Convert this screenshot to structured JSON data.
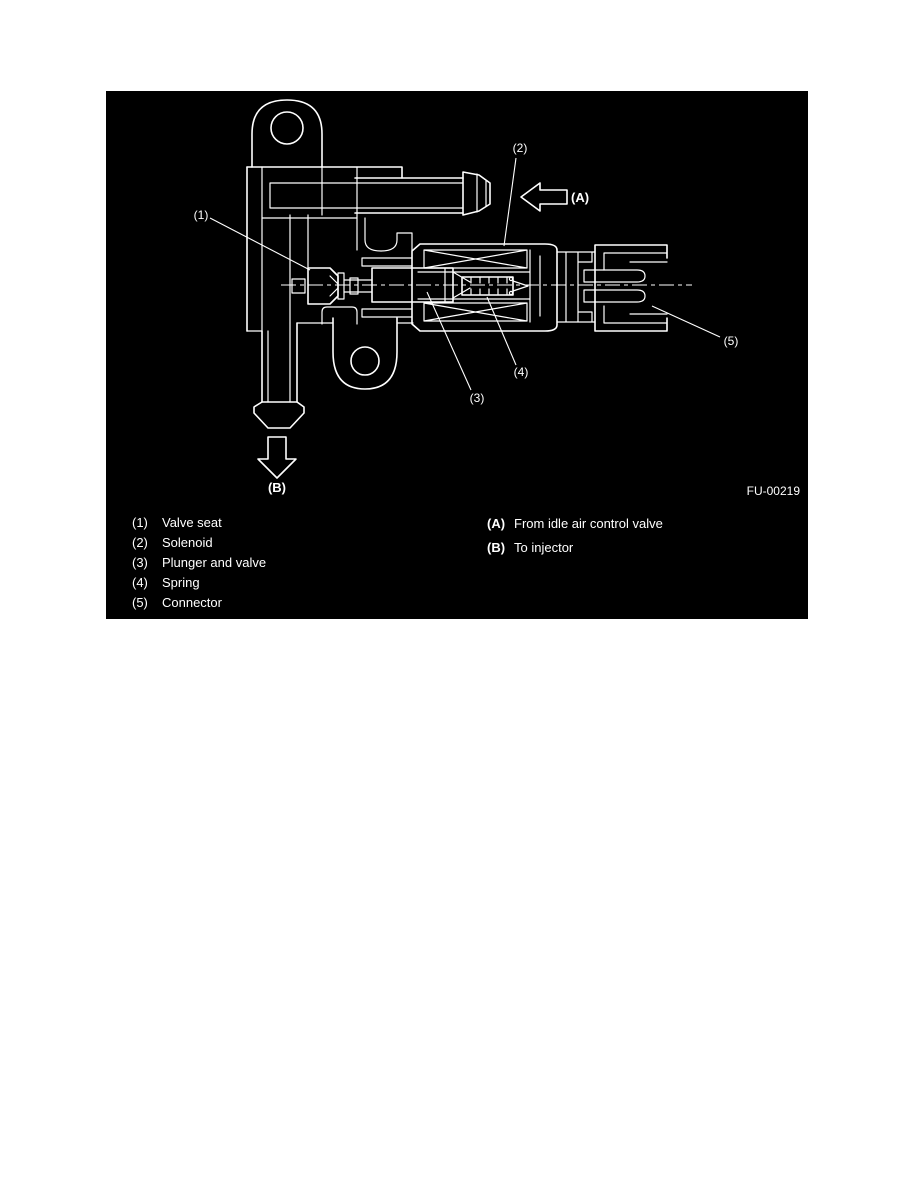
{
  "figure": {
    "code": "FU-00219",
    "callouts": {
      "1": "(1)",
      "2": "(2)",
      "3": "(3)",
      "4": "(4)",
      "5": "(5)",
      "A": "(A)",
      "B": "(B)"
    },
    "legend_left": [
      {
        "marker": "(1)",
        "label": "Valve seat"
      },
      {
        "marker": "(2)",
        "label": "Solenoid"
      },
      {
        "marker": "(3)",
        "label": "Plunger and valve"
      },
      {
        "marker": "(4)",
        "label": "Spring"
      },
      {
        "marker": "(5)",
        "label": "Connector"
      }
    ],
    "legend_right": [
      {
        "marker": "(A)",
        "label": "From idle air control valve"
      },
      {
        "marker": "(B)",
        "label": "To injector"
      }
    ],
    "colors": {
      "panel_bg": "#000000",
      "line": "#ffffff"
    }
  }
}
